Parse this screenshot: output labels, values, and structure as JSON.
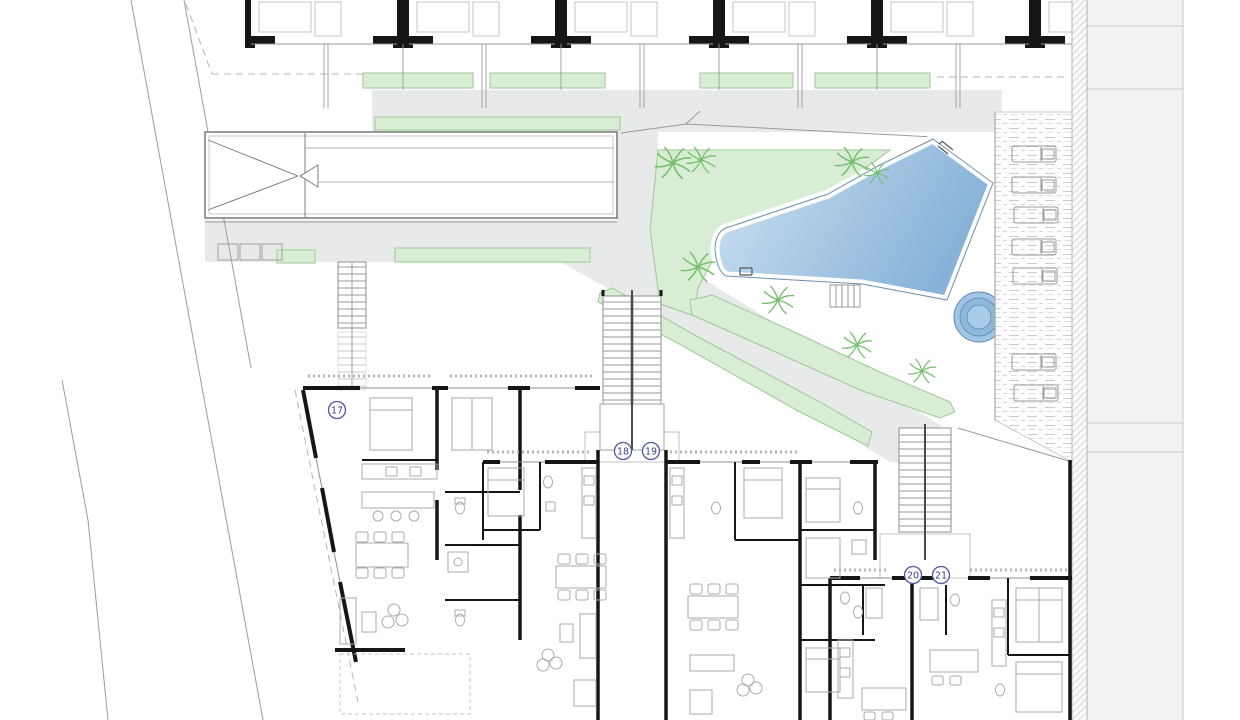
{
  "drawing": {
    "kind": "residential site plan / ground floor plan",
    "units": [
      {
        "label": "17",
        "x": 337,
        "y": 410
      },
      {
        "label": "18",
        "x": 623,
        "y": 451
      },
      {
        "label": "19",
        "x": 651,
        "y": 451
      },
      {
        "label": "20",
        "x": 913,
        "y": 575
      },
      {
        "label": "21",
        "y": 575,
        "x": 941
      }
    ],
    "site": {
      "palms": [
        {
          "x": 673,
          "y": 163,
          "r": 17
        },
        {
          "x": 701,
          "y": 160,
          "r": 14
        },
        {
          "x": 852,
          "y": 162,
          "r": 16
        },
        {
          "x": 877,
          "y": 173,
          "r": 12
        },
        {
          "x": 698,
          "y": 267,
          "r": 16
        },
        {
          "x": 778,
          "y": 300,
          "r": 15
        },
        {
          "x": 857,
          "y": 345,
          "r": 14
        },
        {
          "x": 922,
          "y": 371,
          "r": 13
        }
      ],
      "cars": [
        {
          "x": 1012,
          "y": 146
        },
        {
          "x": 1012,
          "y": 177
        },
        {
          "x": 1014,
          "y": 207
        },
        {
          "x": 1012,
          "y": 239
        },
        {
          "x": 1013,
          "y": 268
        },
        {
          "x": 1012,
          "y": 354
        },
        {
          "x": 1014,
          "y": 385
        }
      ],
      "features": [
        "swimming-pool",
        "spa-circle",
        "pool-garden",
        "parking-strip",
        "garage-ramp",
        "staircases",
        "planters",
        "boundary-hatch"
      ]
    },
    "palette": {
      "wall": "#161616",
      "thin_line": "#8f8f8f",
      "furniture": "#ababab",
      "paving_gray": "#e8e9e9",
      "road_gray": "#f1f2f2",
      "planter_green": "#d9ecd4",
      "planter_edge": "#9fc79a",
      "palm_green": "#74c06c",
      "pool_light": "#c9e0f2",
      "pool_deep": "#86b1d8",
      "pool_edge": "#6b8fae",
      "label_ring": "#5056a0",
      "label_text": "#3c3f8f"
    }
  }
}
